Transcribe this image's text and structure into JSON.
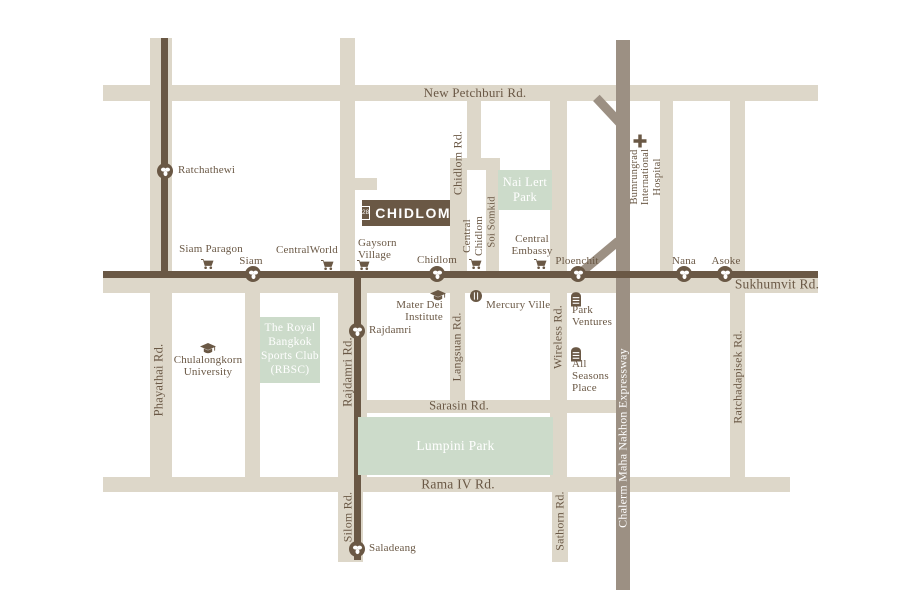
{
  "logo": {
    "label": "CHIDLOM",
    "badge": "28"
  },
  "colors": {
    "road": "#ddd7c9",
    "ink": "#6a5845",
    "park": "#ccdbca",
    "expressway": "#9c9083",
    "background": "#ffffff",
    "label_on_expressway": "#ffffff"
  },
  "map": {
    "shapes": [
      {
        "name": "new-petchburi-road",
        "cls": "road",
        "x": 103,
        "y": 85,
        "w": 715,
        "h": 16
      },
      {
        "name": "sukhumvit-road",
        "cls": "road",
        "x": 103,
        "y": 277,
        "w": 715,
        "h": 16
      },
      {
        "name": "sarasin-road",
        "cls": "road",
        "x": 338,
        "y": 400,
        "w": 282,
        "h": 13
      },
      {
        "name": "rama4-road",
        "cls": "road",
        "x": 103,
        "y": 477,
        "w": 687,
        "h": 15
      },
      {
        "name": "chidlom-connector-road",
        "cls": "road",
        "x": 450,
        "y": 158,
        "w": 50,
        "h": 12
      },
      {
        "name": "site-access-road",
        "cls": "road",
        "x": 355,
        "y": 178,
        "w": 22,
        "h": 12
      },
      {
        "name": "phayathai-road",
        "cls": "road",
        "x": 150,
        "y": 38,
        "w": 22,
        "h": 454
      },
      {
        "name": "henri-dunant-road",
        "cls": "road",
        "x": 245,
        "y": 290,
        "w": 15,
        "h": 188
      },
      {
        "name": "ratchadamri-north-road",
        "cls": "road",
        "x": 340,
        "y": 38,
        "w": 15,
        "h": 255
      },
      {
        "name": "ratchadamri-road",
        "cls": "road",
        "x": 338,
        "y": 290,
        "w": 29,
        "h": 188
      },
      {
        "name": "silom-road",
        "cls": "road",
        "x": 338,
        "y": 492,
        "w": 25,
        "h": 70
      },
      {
        "name": "chidlom-road-upper",
        "cls": "road",
        "x": 467,
        "y": 101,
        "w": 14,
        "h": 64
      },
      {
        "name": "chidlom-road",
        "cls": "road",
        "x": 450,
        "y": 158,
        "w": 17,
        "h": 119
      },
      {
        "name": "langsuan-road",
        "cls": "road",
        "x": 450,
        "y": 293,
        "w": 15,
        "h": 120
      },
      {
        "name": "soi-somkid-road",
        "cls": "road",
        "x": 486,
        "y": 165,
        "w": 13,
        "h": 112
      },
      {
        "name": "wireless-road",
        "cls": "road",
        "x": 550,
        "y": 101,
        "w": 17,
        "h": 377
      },
      {
        "name": "sathorn-road",
        "cls": "road",
        "x": 552,
        "y": 492,
        "w": 16,
        "h": 70
      },
      {
        "name": "nana-soi-road",
        "cls": "road",
        "x": 660,
        "y": 101,
        "w": 13,
        "h": 176
      },
      {
        "name": "ratchadapisek-road",
        "cls": "road",
        "x": 730,
        "y": 101,
        "w": 15,
        "h": 376
      },
      {
        "name": "expressway",
        "cls": "exp",
        "x": 616,
        "y": 40,
        "w": 14,
        "h": 550
      },
      {
        "name": "expressway-ramp-north",
        "cls": "exp",
        "x": 590,
        "y": 108,
        "w": 40,
        "h": 9,
        "rot": 47
      },
      {
        "name": "expressway-ramp-ploenchit",
        "cls": "exp",
        "x": 576,
        "y": 252,
        "w": 48,
        "h": 9,
        "rot": -40
      },
      {
        "name": "bts-sukhumvit-line",
        "cls": "dark",
        "x": 103,
        "y": 271,
        "w": 715,
        "h": 7
      },
      {
        "name": "bts-phayathai-line",
        "cls": "dark",
        "x": 161,
        "y": 38,
        "w": 7,
        "h": 237
      },
      {
        "name": "bts-silom-line",
        "cls": "dark",
        "x": 354,
        "y": 274,
        "w": 7,
        "h": 286
      }
    ],
    "parks": [
      {
        "name": "nai-lert-park",
        "x": 498,
        "y": 170,
        "w": 54,
        "h": 40,
        "size": 12.5,
        "label": "Nai Lert\nPark"
      },
      {
        "name": "rbsc-park",
        "x": 260,
        "y": 317,
        "w": 60,
        "h": 66,
        "size": 11.5,
        "label": "The Royal\nBangkok\nSports Club\n(RBSC)"
      },
      {
        "name": "lumpini-park",
        "x": 358,
        "y": 417,
        "w": 195,
        "h": 58,
        "size": 13.5,
        "label": "Lumpini Park"
      }
    ],
    "labels": [
      {
        "name": "new-petchburi-road-label",
        "text": "New Petchburi Rd.",
        "x": 475,
        "y": 93,
        "align": "c"
      },
      {
        "name": "sukhumvit-road-label",
        "text": "Sukhumvit Rd.",
        "x": 777,
        "y": 285,
        "align": "c",
        "size": 13.5
      },
      {
        "name": "sarasin-road-label",
        "text": "Sarasin Rd.",
        "x": 459,
        "y": 406,
        "align": "c",
        "size": 12.5
      },
      {
        "name": "rama4-road-label",
        "text": "Rama IV Rd.",
        "x": 458,
        "y": 485,
        "align": "c",
        "size": 13.5
      },
      {
        "name": "phayathai-road-label",
        "text": "Phayathai Rd.",
        "x": 159,
        "y": 380,
        "rot": true,
        "size": 12.5
      },
      {
        "name": "rajdamri-road-label",
        "text": "Rajdamri Rd.",
        "x": 348,
        "y": 372,
        "rot": true,
        "size": 12.5
      },
      {
        "name": "silom-road-label",
        "text": "Silom Rd.",
        "x": 348,
        "y": 517,
        "rot": true,
        "size": 12
      },
      {
        "name": "chidlom-road-label",
        "text": "Chidlom Rd.",
        "x": 458,
        "y": 163,
        "rot": true,
        "size": 12
      },
      {
        "name": "langsuan-road-label",
        "text": "Langsuan Rd.",
        "x": 457,
        "y": 347,
        "rot": true,
        "size": 12
      },
      {
        "name": "soi-somkid-label",
        "text": "Soi Somkid",
        "x": 492,
        "y": 222,
        "rot": true,
        "size": 10.5
      },
      {
        "name": "wireless-road-label",
        "text": "Wireless Rd.",
        "x": 558,
        "y": 337,
        "rot": true,
        "size": 12
      },
      {
        "name": "sathorn-road-label",
        "text": "Sathorn Rd.",
        "x": 560,
        "y": 521,
        "rot": true,
        "size": 12
      },
      {
        "name": "ratchadapisek-road-label",
        "text": "Ratchadapisek Rd.",
        "x": 738,
        "y": 377,
        "rot": true,
        "size": 12
      },
      {
        "name": "expressway-label",
        "text": "Chalerm Maha Nakhon Expressway",
        "x": 623,
        "y": 438,
        "rot": true,
        "size": 12,
        "color": "#ffffff"
      },
      {
        "name": "bumrungrad-hospital-label",
        "text": "Bumrungrad\nInternational\nHospital",
        "x": 646,
        "y": 177,
        "rotml": true,
        "size": 10.5
      },
      {
        "name": "ratchathewi-station-label",
        "text": "Ratchathewi",
        "x": 178,
        "y": 171,
        "align": "l",
        "size": 11
      },
      {
        "name": "siam-station-label",
        "text": "Siam",
        "x": 251,
        "y": 262,
        "align": "c",
        "size": 11
      },
      {
        "name": "chidlom-station-label",
        "text": "Chidlom",
        "x": 437,
        "y": 261,
        "align": "c",
        "size": 11
      },
      {
        "name": "ploenchit-station-label",
        "text": "Ploenchit",
        "x": 577,
        "y": 262,
        "align": "c",
        "size": 11
      },
      {
        "name": "nana-station-label",
        "text": "Nana",
        "x": 684,
        "y": 262,
        "align": "c",
        "size": 11
      },
      {
        "name": "asoke-station-label",
        "text": "Asoke",
        "x": 726,
        "y": 262,
        "align": "c",
        "size": 11
      },
      {
        "name": "rajdamri-station-label",
        "text": "Rajdamri",
        "x": 369,
        "y": 331,
        "align": "l",
        "size": 11
      },
      {
        "name": "saladeang-station-label",
        "text": "Saladeang",
        "x": 369,
        "y": 549,
        "align": "l",
        "size": 11
      },
      {
        "name": "siam-paragon-label",
        "text": "Siam Paragon",
        "x": 211,
        "y": 250,
        "align": "c",
        "size": 11
      },
      {
        "name": "centralworld-label",
        "text": "CentralWorld",
        "x": 307,
        "y": 251,
        "align": "c",
        "size": 11
      },
      {
        "name": "gaysorn-village-label",
        "text": "Gaysorn\nVillage",
        "x": 358,
        "y": 250,
        "align": "l",
        "size": 11
      },
      {
        "name": "central-chidlom-label",
        "text": "Central\nChidlom",
        "x": 474,
        "y": 236,
        "rotml": true,
        "size": 11
      },
      {
        "name": "central-embassy-label",
        "text": "Central\nEmbassy",
        "x": 532,
        "y": 246,
        "align": "c",
        "size": 11
      },
      {
        "name": "mater-dei-label",
        "text": "Mater Dei\nInstitute",
        "x": 443,
        "y": 312,
        "align": "r",
        "size": 11
      },
      {
        "name": "mercury-ville-label",
        "text": "Mercury Ville",
        "x": 486,
        "y": 306,
        "align": "l",
        "size": 11
      },
      {
        "name": "park-ventures-label",
        "text": "Park\nVentures",
        "x": 572,
        "y": 317,
        "align": "l",
        "size": 11
      },
      {
        "name": "all-seasons-place-label",
        "text": "All\nSeasons\nPlace",
        "x": 572,
        "y": 377,
        "align": "l",
        "size": 11
      },
      {
        "name": "chulalongkorn-university-label",
        "text": "Chulalongkorn\nUniversity",
        "x": 208,
        "y": 367,
        "align": "c",
        "size": 11
      }
    ],
    "stations": [
      {
        "name": "ratchathewi-station",
        "x": 165,
        "y": 171
      },
      {
        "name": "siam-station",
        "x": 253,
        "y": 274
      },
      {
        "name": "chidlom-station",
        "x": 437,
        "y": 274
      },
      {
        "name": "ploenchit-station",
        "x": 578,
        "y": 274
      },
      {
        "name": "nana-station",
        "x": 684,
        "y": 274
      },
      {
        "name": "asoke-station",
        "x": 725,
        "y": 274
      },
      {
        "name": "rajdamri-station",
        "x": 357,
        "y": 331
      },
      {
        "name": "saladeang-station",
        "x": 357,
        "y": 549
      }
    ],
    "icons": [
      {
        "name": "siam-paragon-cart-icon",
        "type": "cart",
        "x": 207,
        "y": 265
      },
      {
        "name": "centralworld-cart-icon",
        "type": "cart",
        "x": 327,
        "y": 266
      },
      {
        "name": "gaysorn-village-cart-icon",
        "type": "cart",
        "x": 363,
        "y": 266
      },
      {
        "name": "central-chidlom-cart-icon",
        "type": "cart",
        "x": 475,
        "y": 265
      },
      {
        "name": "central-embassy-cart-icon",
        "type": "cart",
        "x": 540,
        "y": 265
      },
      {
        "name": "mater-dei-graduation-icon",
        "type": "cap",
        "x": 438,
        "y": 296
      },
      {
        "name": "chulalongkorn-graduation-icon",
        "type": "cap",
        "x": 208,
        "y": 349
      },
      {
        "name": "mercury-ville-dining-icon",
        "type": "dining",
        "x": 476,
        "y": 296
      },
      {
        "name": "park-ventures-building-icon",
        "type": "bld",
        "x": 576,
        "y": 299
      },
      {
        "name": "all-seasons-building-icon",
        "type": "bld",
        "x": 576,
        "y": 354
      },
      {
        "name": "bumrungrad-hospital-cross-icon",
        "type": "cross",
        "x": 640,
        "y": 141
      }
    ]
  }
}
